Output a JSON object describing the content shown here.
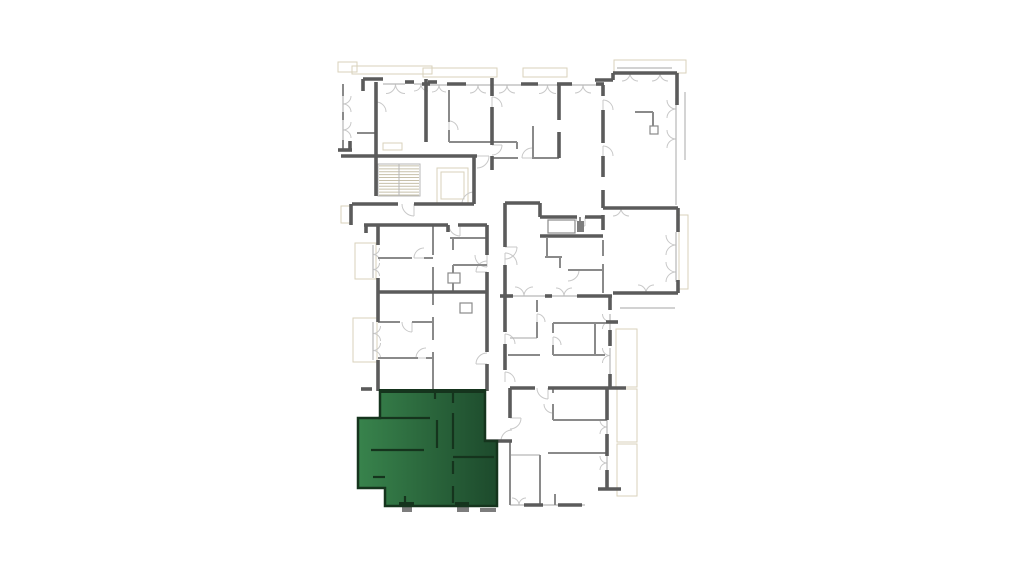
{
  "app": {
    "title": "floor-plan-viewer"
  },
  "canvas": {
    "w": 1024,
    "h": 576,
    "background": "#ffffff"
  },
  "colors": {
    "wall_dark": "#5b5b5b",
    "wall_med": "#8a8a8a",
    "wall_light": "#b7b7b7",
    "arc": "#c8c8c8",
    "balcony": "#d9d2bb",
    "stair": "#c7c0aa",
    "stub": "#7d7d7d"
  },
  "highlight_unit": {
    "label": "selected-apartment",
    "points": "380,391 485,391 485,441 497,441 497,506 385,506 385,488 358,488 358,418 380,418",
    "gradient": {
      "from": "#38834c",
      "to": "#1d4a2c"
    },
    "wall_color": "#15341d",
    "top_edge": [
      379,
      391,
      486,
      391
    ],
    "interior_walls": [
      [
        378,
        418,
        430,
        418
      ],
      [
        371,
        450,
        424,
        450
      ],
      [
        437,
        420,
        437,
        448
      ],
      [
        453,
        391,
        453,
        403
      ],
      [
        453,
        413,
        453,
        449
      ],
      [
        453,
        457,
        494,
        457
      ],
      [
        453,
        461,
        453,
        474
      ],
      [
        453,
        486,
        453,
        503
      ],
      [
        373,
        477,
        385,
        477
      ],
      [
        405,
        496,
        405,
        504
      ],
      [
        435,
        391,
        435,
        399
      ]
    ],
    "piers": [
      [
        399,
        502,
        15,
        5
      ],
      [
        455,
        502,
        14,
        5
      ]
    ]
  },
  "floorplan": {
    "stairs": {
      "x": 378,
      "y": 164,
      "w": 42,
      "h": 32,
      "treads": 11
    },
    "elevator": {
      "outer": [
        437,
        168,
        31,
        35
      ],
      "inner": [
        441,
        172,
        23,
        27
      ]
    },
    "balconies": [
      [
        338,
        62,
        19,
        10
      ],
      [
        352,
        66,
        80,
        8
      ],
      [
        423,
        68,
        74,
        9
      ],
      [
        523,
        68,
        44,
        9
      ],
      [
        614,
        60,
        72,
        13
      ],
      [
        679,
        215,
        9,
        74
      ],
      [
        355,
        243,
        21,
        36
      ],
      [
        353,
        318,
        24,
        44
      ],
      [
        616,
        329,
        21,
        58
      ],
      [
        617,
        389,
        20,
        53
      ],
      [
        617,
        444,
        20,
        52
      ],
      [
        383,
        143,
        19,
        7
      ],
      [
        341,
        206,
        9,
        17
      ]
    ],
    "shafts": [
      [
        448,
        273,
        12,
        10
      ],
      [
        460,
        303,
        12,
        10
      ],
      [
        650,
        126,
        8,
        8
      ],
      [
        548,
        220,
        27,
        13
      ]
    ],
    "stubs": [
      [
        402,
        507,
        10,
        5
      ],
      [
        457,
        507,
        12,
        5
      ],
      [
        480,
        508,
        16,
        4
      ],
      [
        577,
        221,
        7,
        11
      ]
    ],
    "walls_dark": [
      [
        363,
        79,
        383,
        79
      ],
      [
        363,
        79,
        363,
        91
      ],
      [
        376,
        82,
        376,
        196
      ],
      [
        405,
        82,
        414,
        82
      ],
      [
        428,
        82,
        437,
        82
      ],
      [
        426,
        79,
        426,
        142
      ],
      [
        338,
        150,
        352,
        150
      ],
      [
        350,
        141,
        350,
        150
      ],
      [
        341,
        156,
        477,
        156
      ],
      [
        474,
        156,
        474,
        204
      ],
      [
        352,
        204,
        398,
        204
      ],
      [
        414,
        204,
        474,
        204
      ],
      [
        351,
        204,
        351,
        225
      ],
      [
        364,
        225,
        448,
        225
      ],
      [
        458,
        225,
        487,
        225
      ],
      [
        448,
        225,
        448,
        232
      ],
      [
        366,
        225,
        366,
        233
      ],
      [
        422,
        84,
        430,
        84
      ],
      [
        447,
        84,
        466,
        84
      ],
      [
        521,
        84,
        538,
        84
      ],
      [
        557,
        84,
        572,
        84
      ],
      [
        596,
        84,
        604,
        84
      ],
      [
        492,
        78,
        492,
        96
      ],
      [
        492,
        107,
        492,
        145
      ],
      [
        492,
        156,
        492,
        170
      ],
      [
        559,
        84,
        559,
        120
      ],
      [
        559,
        132,
        559,
        158
      ],
      [
        595,
        80,
        613,
        80
      ],
      [
        613,
        73,
        613,
        80
      ],
      [
        613,
        73,
        677,
        73
      ],
      [
        677,
        73,
        677,
        105
      ],
      [
        603,
        85,
        603,
        96
      ],
      [
        603,
        110,
        603,
        143
      ],
      [
        603,
        156,
        603,
        177
      ],
      [
        603,
        190,
        603,
        208
      ],
      [
        603,
        208,
        678,
        208
      ],
      [
        678,
        208,
        678,
        232
      ],
      [
        678,
        280,
        678,
        293
      ],
      [
        613,
        293,
        678,
        293
      ],
      [
        505,
        203,
        540,
        203
      ],
      [
        505,
        203,
        505,
        247
      ],
      [
        505,
        265,
        505,
        297
      ],
      [
        540,
        203,
        540,
        217
      ],
      [
        540,
        217,
        577,
        217
      ],
      [
        585,
        217,
        603,
        217
      ],
      [
        540,
        236,
        603,
        236
      ],
      [
        603,
        215,
        603,
        230
      ],
      [
        577,
        296,
        612,
        296
      ],
      [
        610,
        296,
        610,
        310
      ],
      [
        500,
        296,
        513,
        296
      ],
      [
        545,
        296,
        552,
        296
      ],
      [
        487,
        225,
        487,
        255
      ],
      [
        487,
        272,
        487,
        352
      ],
      [
        487,
        364,
        487,
        391
      ],
      [
        505,
        296,
        505,
        332
      ],
      [
        505,
        344,
        505,
        370
      ],
      [
        378,
        292,
        487,
        292
      ],
      [
        378,
        225,
        378,
        245
      ],
      [
        378,
        278,
        378,
        322
      ],
      [
        378,
        360,
        378,
        391
      ],
      [
        361,
        389,
        372,
        389
      ],
      [
        510,
        388,
        510,
        418
      ],
      [
        510,
        388,
        535,
        388
      ],
      [
        548,
        388,
        607,
        388
      ],
      [
        607,
        388,
        626,
        388
      ],
      [
        610,
        330,
        610,
        346
      ],
      [
        610,
        374,
        610,
        388
      ],
      [
        606,
        322,
        618,
        322
      ],
      [
        485,
        441,
        512,
        441
      ],
      [
        607,
        388,
        607,
        420
      ],
      [
        607,
        434,
        607,
        456
      ],
      [
        607,
        470,
        607,
        489
      ],
      [
        598,
        489,
        621,
        489
      ],
      [
        524,
        505,
        543,
        505
      ],
      [
        558,
        505,
        582,
        505
      ]
    ],
    "walls_med": [
      [
        343,
        84,
        343,
        96
      ],
      [
        343,
        112,
        343,
        120
      ],
      [
        343,
        140,
        343,
        150
      ],
      [
        357,
        133,
        376,
        133
      ],
      [
        449,
        90,
        449,
        122
      ],
      [
        449,
        130,
        449,
        142
      ],
      [
        449,
        142,
        492,
        142
      ],
      [
        492,
        142,
        517,
        142
      ],
      [
        517,
        142,
        517,
        149
      ],
      [
        533,
        126,
        533,
        158
      ],
      [
        492,
        158,
        518,
        158
      ],
      [
        532,
        158,
        559,
        158
      ],
      [
        635,
        112,
        653,
        112
      ],
      [
        653,
        112,
        653,
        133
      ],
      [
        433,
        225,
        433,
        255
      ],
      [
        433,
        267,
        433,
        292
      ],
      [
        378,
        258,
        412,
        258
      ],
      [
        424,
        258,
        433,
        258
      ],
      [
        433,
        292,
        433,
        305
      ],
      [
        433,
        317,
        433,
        340
      ],
      [
        433,
        352,
        433,
        391
      ],
      [
        378,
        322,
        400,
        322
      ],
      [
        412,
        322,
        433,
        322
      ],
      [
        378,
        358,
        418,
        358
      ],
      [
        426,
        358,
        433,
        358
      ],
      [
        450,
        238,
        487,
        238
      ],
      [
        453,
        238,
        453,
        250
      ],
      [
        453,
        265,
        453,
        292
      ],
      [
        453,
        265,
        487,
        265
      ],
      [
        547,
        238,
        547,
        258
      ],
      [
        545,
        257,
        562,
        257
      ],
      [
        560,
        257,
        560,
        268
      ],
      [
        568,
        270,
        603,
        270
      ],
      [
        603,
        240,
        603,
        256
      ],
      [
        603,
        264,
        603,
        293
      ],
      [
        580,
        217,
        580,
        224
      ],
      [
        553,
        323,
        606,
        323
      ],
      [
        553,
        355,
        605,
        355
      ],
      [
        508,
        355,
        540,
        355
      ],
      [
        553,
        323,
        553,
        333
      ],
      [
        553,
        345,
        553,
        355
      ],
      [
        595,
        323,
        595,
        355
      ],
      [
        537,
        300,
        537,
        312
      ],
      [
        537,
        322,
        537,
        338
      ],
      [
        553,
        404,
        553,
        420
      ],
      [
        553,
        388,
        553,
        393
      ],
      [
        553,
        420,
        607,
        420
      ],
      [
        548,
        453,
        607,
        453
      ],
      [
        540,
        455,
        540,
        505
      ],
      [
        510,
        440,
        510,
        505
      ],
      [
        555,
        494,
        555,
        505
      ]
    ],
    "walls_light": [
      [
        430,
        85,
        447,
        85
      ],
      [
        466,
        85,
        521,
        85
      ],
      [
        538,
        85,
        557,
        85
      ],
      [
        572,
        85,
        596,
        85
      ],
      [
        383,
        84,
        405,
        84
      ],
      [
        414,
        84,
        428,
        84
      ],
      [
        343,
        96,
        343,
        112
      ],
      [
        343,
        120,
        343,
        140
      ],
      [
        373,
        245,
        373,
        278
      ],
      [
        373,
        322,
        373,
        360
      ],
      [
        676,
        98,
        676,
        205
      ],
      [
        676,
        232,
        676,
        280
      ],
      [
        617,
        68,
        672,
        68
      ],
      [
        685,
        92,
        685,
        160
      ],
      [
        513,
        296,
        545,
        296
      ],
      [
        552,
        296,
        577,
        296
      ],
      [
        610,
        314,
        610,
        330
      ],
      [
        610,
        348,
        610,
        374
      ],
      [
        607,
        420,
        607,
        434
      ],
      [
        607,
        456,
        607,
        470
      ],
      [
        510,
        505,
        585,
        505
      ],
      [
        510,
        338,
        537,
        338
      ],
      [
        510,
        455,
        540,
        455
      ],
      [
        620,
        308,
        675,
        308
      ]
    ],
    "windows_h": [
      [
        386,
        84,
        19,
        1
      ],
      [
        414,
        84,
        14,
        1
      ],
      [
        432,
        85,
        14,
        1
      ],
      [
        470,
        85,
        16,
        1
      ],
      [
        499,
        85,
        16,
        1
      ],
      [
        539,
        85,
        17,
        1
      ],
      [
        575,
        85,
        16,
        1
      ],
      [
        622,
        73,
        16,
        1
      ],
      [
        652,
        73,
        16,
        1
      ],
      [
        613,
        208,
        16,
        1
      ],
      [
        515,
        296,
        18,
        -1
      ],
      [
        556,
        296,
        16,
        -1
      ],
      [
        638,
        293,
        16,
        -1
      ],
      [
        512,
        505,
        14,
        -1
      ]
    ],
    "windows_v": [
      [
        343,
        96,
        16,
        1
      ],
      [
        343,
        122,
        16,
        1
      ],
      [
        373,
        248,
        13,
        1
      ],
      [
        373,
        263,
        13,
        1
      ],
      [
        373,
        326,
        15,
        1
      ],
      [
        373,
        343,
        15,
        1
      ],
      [
        676,
        100,
        18,
        -1
      ],
      [
        676,
        130,
        18,
        -1
      ],
      [
        676,
        235,
        20,
        -1
      ],
      [
        676,
        262,
        20,
        -1
      ],
      [
        610,
        314,
        15,
        -1
      ],
      [
        610,
        348,
        15,
        -1
      ],
      [
        607,
        420,
        14,
        -1
      ],
      [
        607,
        456,
        14,
        -1
      ]
    ],
    "door_arcs": [
      [
        460,
        225,
        11,
        90,
        180
      ],
      [
        487,
        272,
        11,
        180,
        270
      ],
      [
        487,
        255,
        12,
        90,
        180
      ],
      [
        487,
        364,
        11,
        180,
        270
      ],
      [
        505,
        247,
        12,
        0,
        90
      ],
      [
        505,
        265,
        12,
        270,
        360
      ],
      [
        505,
        344,
        10,
        270,
        360
      ],
      [
        505,
        382,
        10,
        270,
        360
      ],
      [
        548,
        388,
        11,
        90,
        180
      ],
      [
        512,
        441,
        11,
        180,
        270
      ],
      [
        510,
        418,
        11,
        0,
        90
      ],
      [
        474,
        204,
        12,
        180,
        270
      ],
      [
        477,
        156,
        12,
        0,
        90
      ],
      [
        414,
        204,
        12,
        90,
        180
      ],
      [
        424,
        258,
        10,
        180,
        270
      ],
      [
        412,
        322,
        10,
        90,
        180
      ],
      [
        426,
        358,
        10,
        180,
        270
      ],
      [
        376,
        112,
        10,
        270,
        360
      ],
      [
        449,
        130,
        9,
        270,
        360
      ],
      [
        532,
        158,
        10,
        180,
        270
      ],
      [
        603,
        110,
        10,
        270,
        360
      ],
      [
        603,
        156,
        10,
        270,
        360
      ],
      [
        553,
        404,
        9,
        90,
        180
      ],
      [
        537,
        322,
        8,
        270,
        360
      ],
      [
        585,
        217,
        9,
        90,
        180
      ],
      [
        568,
        270,
        11,
        0,
        90
      ],
      [
        492,
        107,
        10,
        270,
        360
      ],
      [
        492,
        145,
        10,
        0,
        90
      ],
      [
        553,
        345,
        8,
        270,
        360
      ]
    ]
  }
}
